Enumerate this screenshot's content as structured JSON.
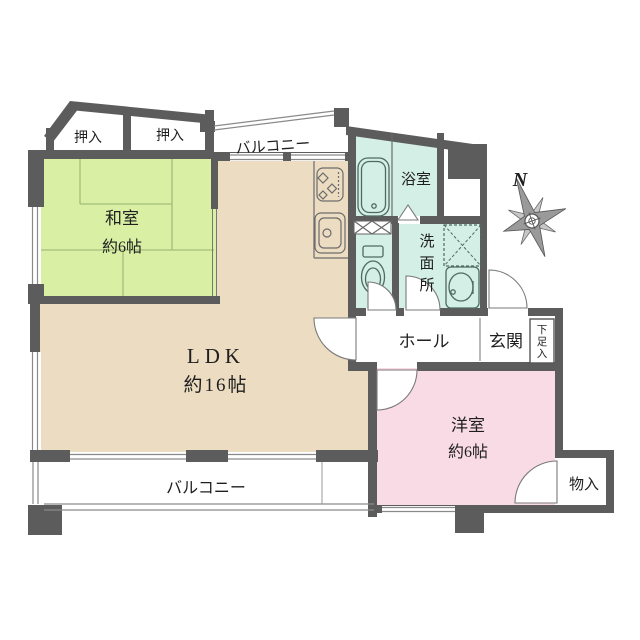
{
  "plan": {
    "rooms": {
      "washitsu": {
        "label": "和室",
        "size": "約6帖"
      },
      "ldk": {
        "label": "LDK",
        "size": "約16帖"
      },
      "youshitsu": {
        "label": "洋室",
        "size": "約6帖"
      },
      "bathroom": {
        "label": "浴室"
      },
      "washroom": {
        "label": "洗面所",
        "chars": [
          "洗",
          "面",
          "所"
        ]
      },
      "hall": {
        "label": "ホール"
      },
      "genkan": {
        "label": "玄関"
      },
      "shoebox": {
        "label": "下足入",
        "chars": [
          "下",
          "足",
          "入"
        ]
      },
      "storage": {
        "label": "物入"
      },
      "closet1": {
        "label": "押入"
      },
      "closet2": {
        "label": "押入"
      },
      "balcony_top": {
        "label": "バルコニー"
      },
      "balcony_bottom": {
        "label": "バルコニー"
      }
    },
    "compass": {
      "north": "N"
    },
    "colors": {
      "wall": "#5c5c5c",
      "tatami_green": "#d9f0a4",
      "ldk_beige": "#ecdcc2",
      "wet_cyan": "#d4efe5",
      "bedroom_pink": "#f9dbe5",
      "background": "#ffffff"
    }
  }
}
